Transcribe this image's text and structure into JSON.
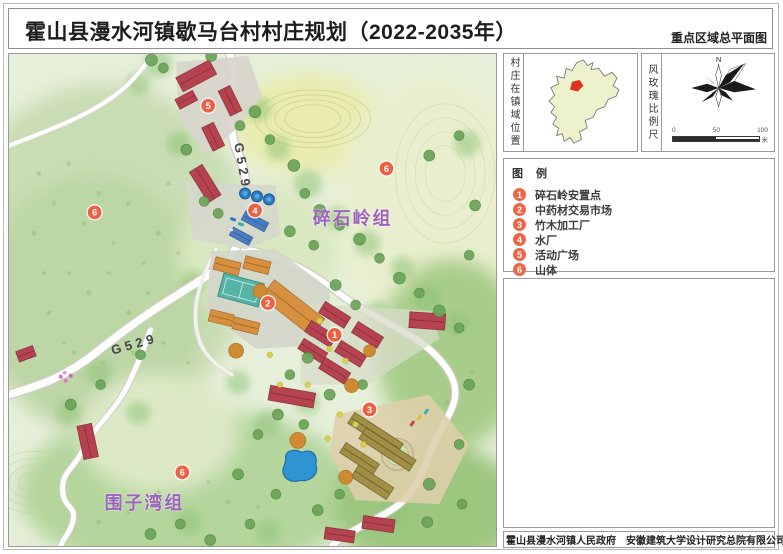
{
  "title": {
    "main": "霍山县漫水河镇歇马台村村庄规划（2022-2035年）",
    "right": "重点区域总平面图"
  },
  "map": {
    "road_label": "G529",
    "groups": [
      {
        "name": "碎石岭组"
      },
      {
        "name": "围子湾组"
      }
    ]
  },
  "sidebar": {
    "location_panel": {
      "label": "村庄在镇域位置"
    },
    "windrose_panel": {
      "label": "风玫瑰比例尺",
      "north": "N",
      "scale_ticks": [
        "0",
        "50",
        "100"
      ],
      "scale_unit": "米"
    }
  },
  "legend": {
    "title": "图 例",
    "items": [
      {
        "num": "1",
        "label": "碎石岭安置点"
      },
      {
        "num": "2",
        "label": "中药材交易市场"
      },
      {
        "num": "3",
        "label": "竹木加工厂"
      },
      {
        "num": "4",
        "label": "水厂"
      },
      {
        "num": "5",
        "label": "活动广场"
      },
      {
        "num": "6",
        "label": "山体"
      }
    ]
  },
  "footer": {
    "text": "霍山县漫水河镇人民政府　安徽建筑大学设计研究总院有限公司"
  },
  "colors": {
    "marker": "#EC6043",
    "group_label": "#9C63BC",
    "roof_red": "#B5434F",
    "roof_orange": "#D6903F",
    "roof_brown": "#A08F45",
    "water_blue": "#2F95D2",
    "court_teal": "#55B4A6",
    "inset_fill": "#EDF2CD",
    "inset_highlight": "#E03020"
  }
}
